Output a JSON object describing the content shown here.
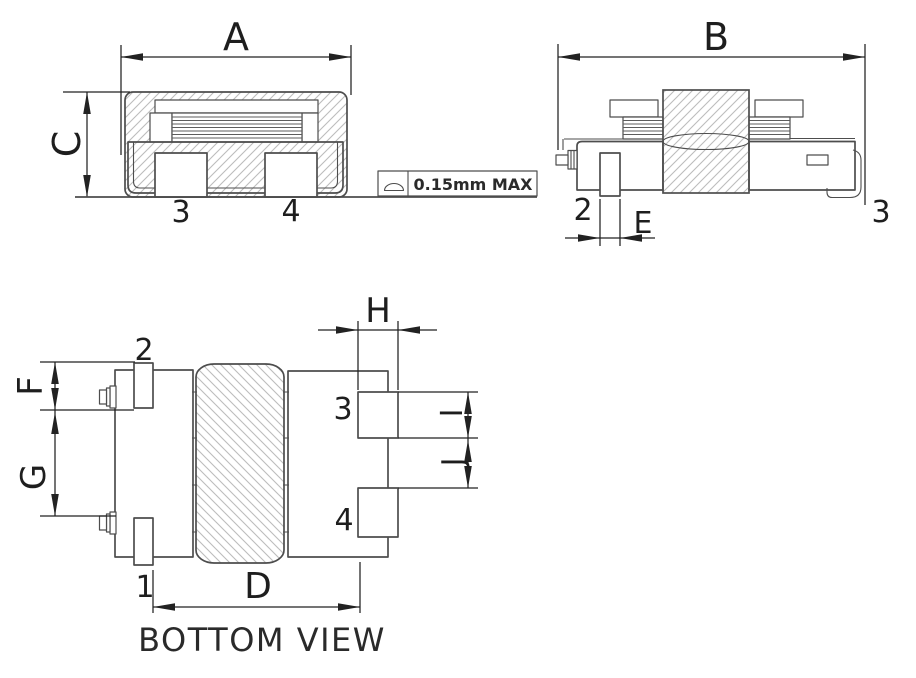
{
  "drawing": {
    "caption": "BOTTOM VIEW",
    "note": {
      "text": "0.15mm MAX",
      "symbol": "coplanarity-flatness-symbol"
    },
    "dims": {
      "a": "A",
      "b": "B",
      "c": "C",
      "d": "D",
      "e": "E",
      "f": "F",
      "g": "G",
      "h": "H",
      "i": "I",
      "j": "J"
    },
    "pins": {
      "front_pad_left": "3",
      "front_pad_right": "4",
      "side_pin_left": "2",
      "side_pin_right": "3",
      "bottom_pin_top_left": "2",
      "bottom_pin_bottom_left": "1",
      "bottom_pad_top_right": "3",
      "bottom_pad_bottom_right": "4"
    },
    "colors": {
      "outline": "#4d4d4d",
      "dimension": "#222222",
      "hatch": "#bdbdbd",
      "background": "#ffffff"
    }
  }
}
